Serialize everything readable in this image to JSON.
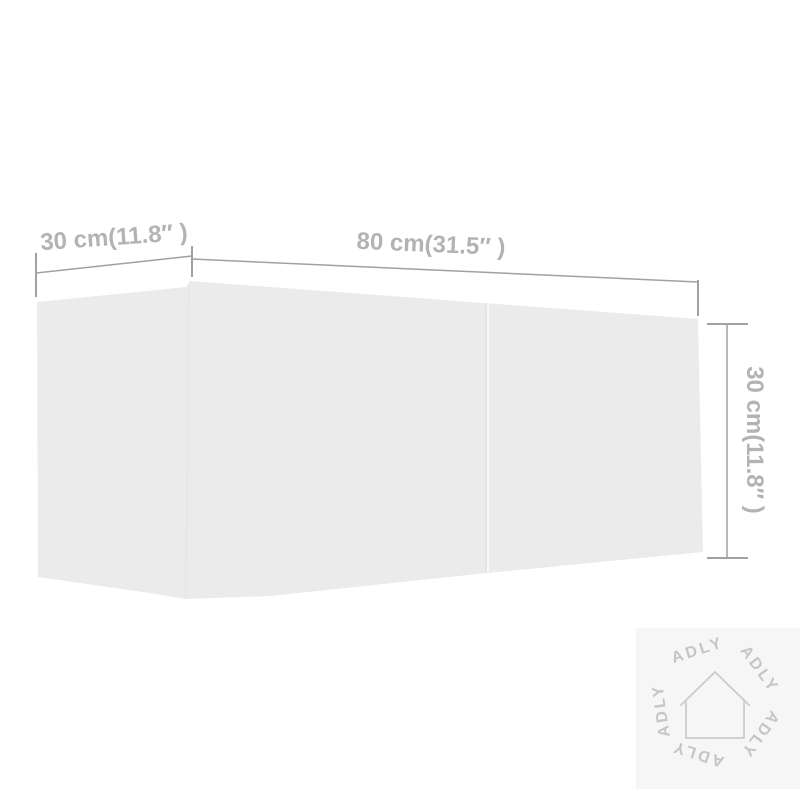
{
  "diagram": {
    "type": "product-dimension-diagram",
    "dimensions": {
      "depth": {
        "label": "30 cm(11.8″ )",
        "cm": 30,
        "inches": 11.8
      },
      "width": {
        "label": "80 cm(31.5″ )",
        "cm": 80,
        "inches": 31.5
      },
      "height": {
        "label": "30 cm(11.8″ )",
        "cm": 30,
        "inches": 11.8
      }
    },
    "colors": {
      "background": "#ffffff",
      "cabinet_fill": "#ebebeb",
      "cabinet_seam_light": "#f7f7f7",
      "cabinet_seam_shadow": "#dcdcdc",
      "dimension_lines": "#a1a1a1",
      "dimension_text": "#b3b3b3"
    }
  },
  "watermark": {
    "brand": "ADLY",
    "icon": "house-outline-icon",
    "colors": {
      "background": "#f6f6f6",
      "text": "#c5c5c5",
      "icon_stroke": "#cbcbcb"
    }
  }
}
